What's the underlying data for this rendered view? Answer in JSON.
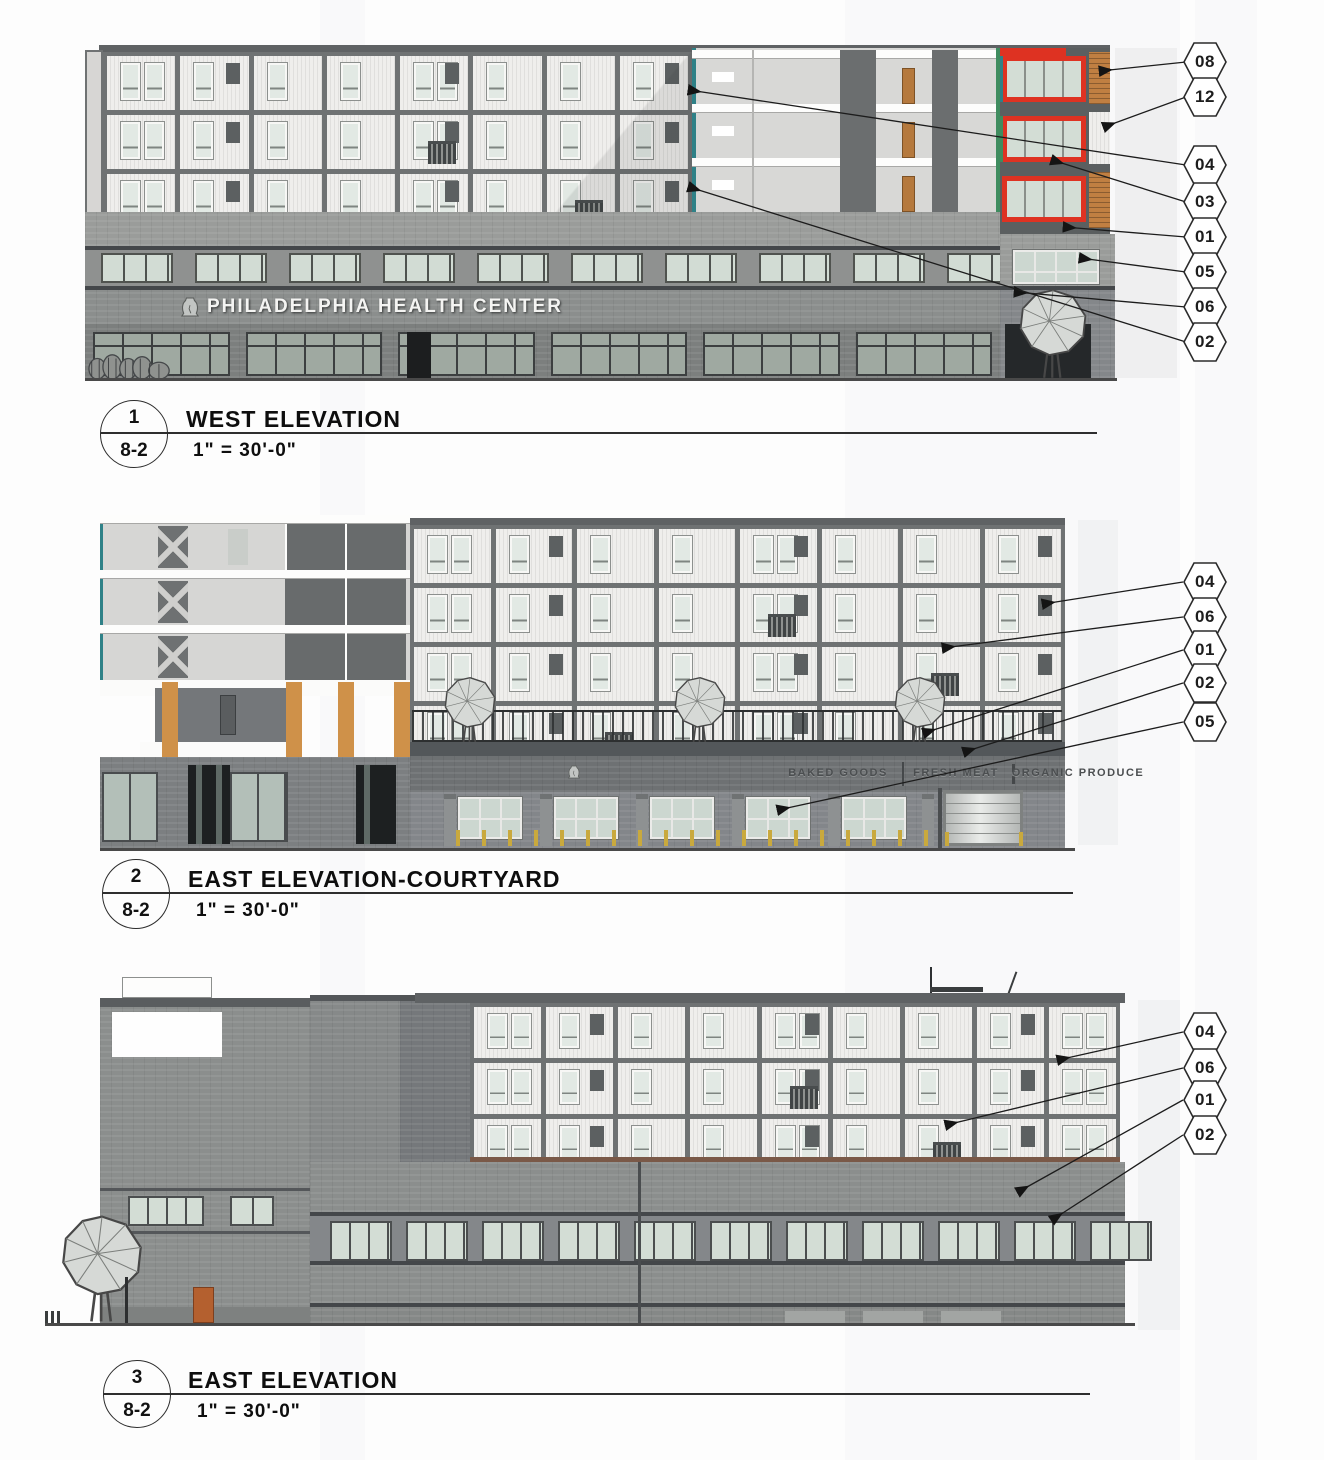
{
  "colors": {
    "red_accent": "#de3222",
    "brick_orange": "#c07f42",
    "pilaster_orange": "#cf9149",
    "bollard_yellow": "#c9a93d",
    "door_orange": "#b4602f",
    "wood_door": "#b5793d",
    "teal_trim": "#2f8187",
    "glass_green": "#d3ddd5",
    "terrace_brown": "#7a5948"
  },
  "elevations": [
    {
      "number": "1",
      "sheet": "8-2",
      "title": "WEST ELEVATION",
      "scale": "1\" = 30'-0\"",
      "building_sign": "PHILADELPHIA HEALTH CENTER",
      "callouts": [
        "08",
        "12",
        "04",
        "03",
        "01",
        "05",
        "06",
        "02"
      ]
    },
    {
      "number": "2",
      "sheet": "8-2",
      "title": "EAST ELEVATION-COURTYARD",
      "scale": "1\" = 30'-0\"",
      "storefront_signs": [
        "BAKED GOODS",
        "FRESH MEAT",
        "ORGANIC PRODUCE"
      ],
      "callouts": [
        "04",
        "06",
        "01",
        "02",
        "05"
      ]
    },
    {
      "number": "3",
      "sheet": "8-2",
      "title": "EAST ELEVATION",
      "scale": "1\" = 30'-0\"",
      "callouts": [
        "04",
        "06",
        "01",
        "02"
      ]
    }
  ]
}
